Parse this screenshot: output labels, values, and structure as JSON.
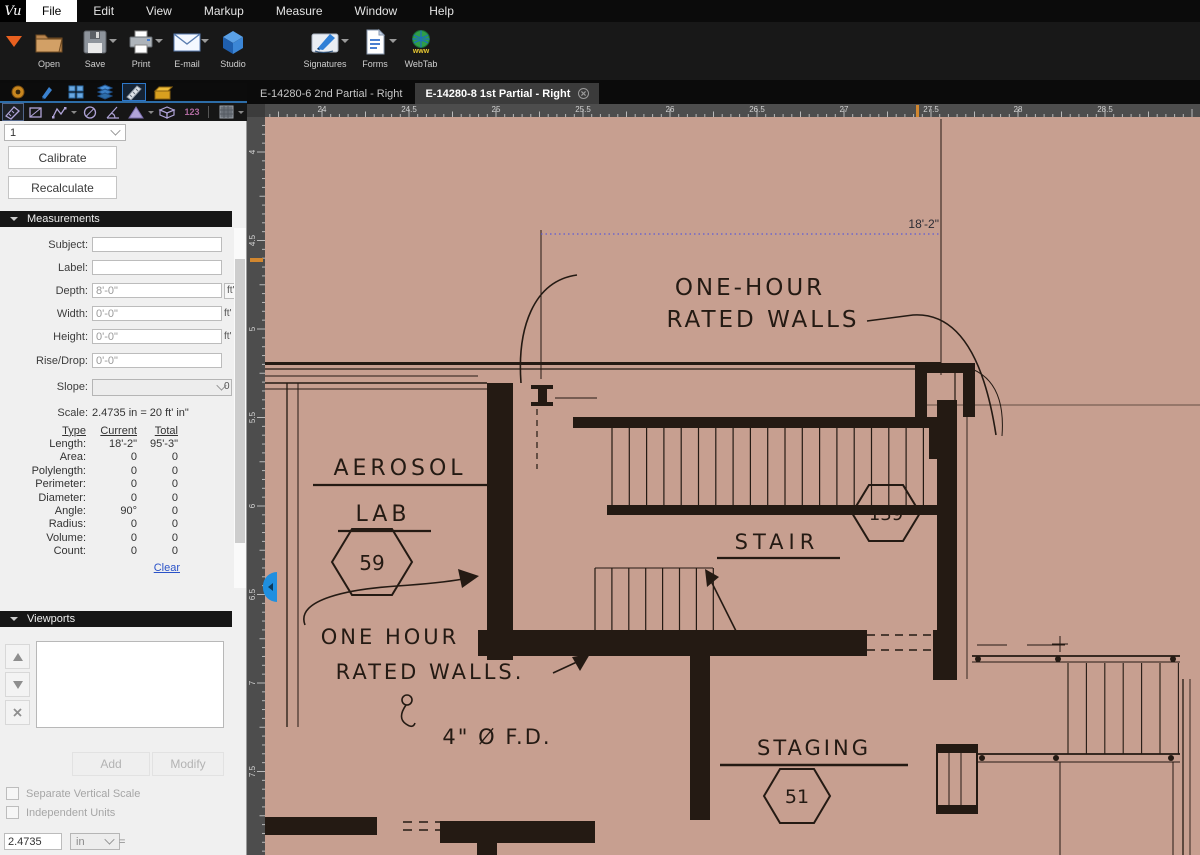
{
  "window": {
    "logo": "Vu"
  },
  "menubar": {
    "items": [
      "File",
      "Edit",
      "View",
      "Markup",
      "Measure",
      "Window",
      "Help"
    ],
    "active_item": "File"
  },
  "toolbar": {
    "buttons": [
      {
        "label": "Open"
      },
      {
        "label": "Save"
      },
      {
        "label": "Print"
      },
      {
        "label": "E-mail"
      },
      {
        "label": "Studio"
      },
      {
        "label": "Signatures"
      },
      {
        "label": "Forms"
      },
      {
        "label": "WebTab"
      }
    ],
    "webtab_icon_text": "www"
  },
  "measure_tools": {
    "count_tool_text": "123"
  },
  "panel": {
    "page_number": "1",
    "calibrate": "Calibrate",
    "recalculate": "Recalculate",
    "measurements_header": "Measurements",
    "fields": [
      {
        "label": "Subject:",
        "value": "",
        "unit": ""
      },
      {
        "label": "Label:",
        "value": "",
        "unit": ""
      },
      {
        "label": "Depth:",
        "value": "8'-0\"",
        "unit": "ft'"
      },
      {
        "label": "Width:",
        "value": "0'-0\"",
        "unit": "ft'"
      },
      {
        "label": "Height:",
        "value": "0'-0\"",
        "unit": "ft'"
      },
      {
        "label": "Rise/Drop:",
        "value": "0'-0\"",
        "unit": ""
      }
    ],
    "slope_label": "Slope:",
    "slope_suffix": "0",
    "scale_label": "Scale:",
    "scale_value": "2.4735 in = 20 ft' in\"",
    "table": {
      "headers": [
        "Type",
        "Current",
        "Total"
      ],
      "rows": [
        {
          "type": "Length:",
          "current": "18'-2\"",
          "total": "95'-3\""
        },
        {
          "type": "Area:",
          "current": "0",
          "total": "0"
        },
        {
          "type": "Polylength:",
          "current": "0",
          "total": "0"
        },
        {
          "type": "Perimeter:",
          "current": "0",
          "total": "0"
        },
        {
          "type": "Diameter:",
          "current": "0",
          "total": "0"
        },
        {
          "type": "Angle:",
          "current": "90°",
          "total": "0"
        },
        {
          "type": "Radius:",
          "current": "0",
          "total": "0"
        },
        {
          "type": "Volume:",
          "current": "0",
          "total": "0"
        },
        {
          "type": "Count:",
          "current": "0",
          "total": "0"
        }
      ],
      "clear": "Clear"
    },
    "viewports_header": "Viewports",
    "add": "Add",
    "modify": "Modify",
    "checkbox1": "Separate Vertical Scale",
    "checkbox2": "Independent Units",
    "scale_input": "2.4735",
    "scale_unit": "in",
    "equals": "="
  },
  "document": {
    "tabs": [
      {
        "label": "E-14280-6 2nd Partial - Right"
      },
      {
        "label": "E-14280-8 1st Partial - Right"
      }
    ],
    "ruler_h_labels": [
      "24",
      "24.5",
      "25",
      "25.5",
      "26",
      "26.5",
      "27",
      "27.5",
      "28",
      "28.5"
    ],
    "ruler_v_labels": [
      "4",
      "4.5",
      "5",
      "5.5",
      "6",
      "6.5",
      "7",
      "7.5"
    ],
    "drawing": {
      "dimension": "18'-2\"",
      "note_top_1": "ONE-HOUR",
      "note_top_2": "RATED WALLS",
      "room1_name_1": "AEROSOL",
      "room1_name_2": "LAB",
      "room1_number": "59",
      "room2_name": "STAIR",
      "room2_number": "139",
      "note_bottom_1": "ONE HOUR",
      "note_bottom_2": "RATED WALLS.",
      "drain_note": "4\" Ø F.D.",
      "room3_name": "STAGING",
      "room3_number": "51"
    }
  },
  "colors": {
    "accent_blue": "#2d6da8",
    "paper": "#c79f90",
    "ink": "#241a13",
    "measure_blue": "#5b5bd6",
    "orange_marker": "#d2872f"
  }
}
